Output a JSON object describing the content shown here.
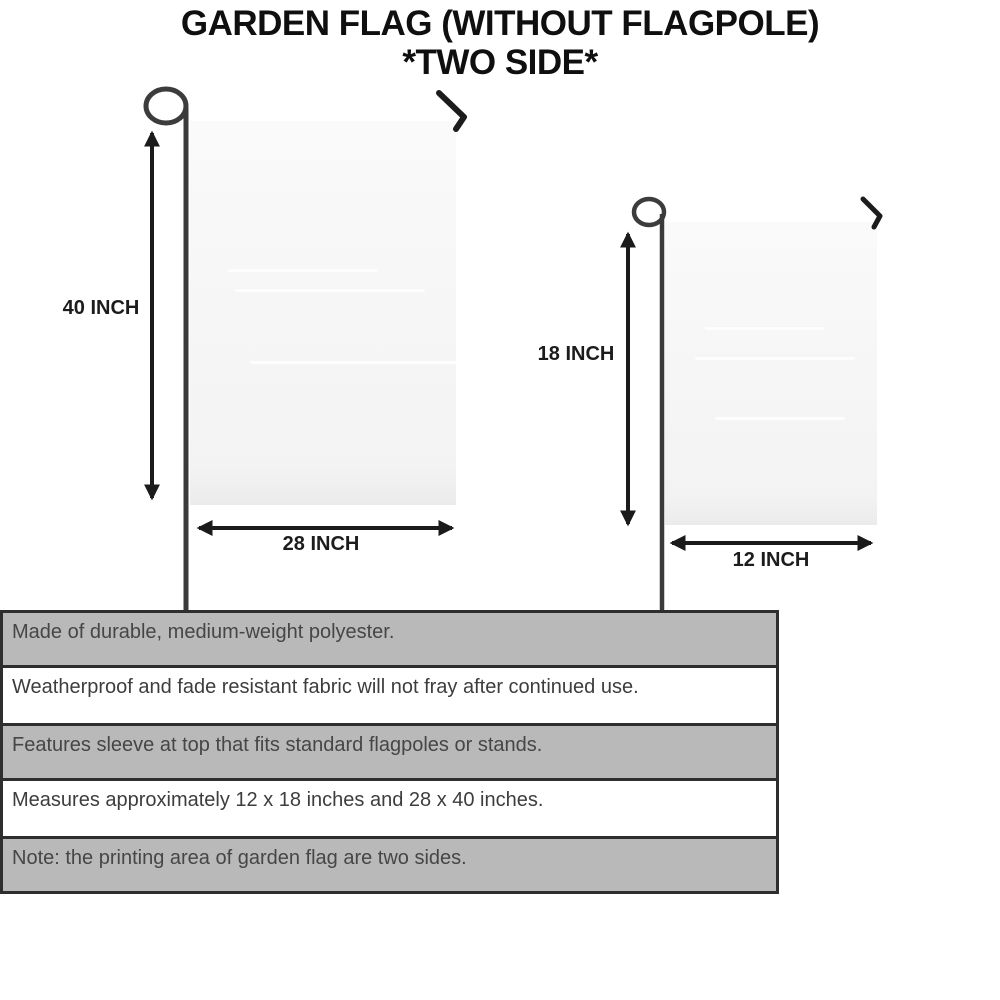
{
  "title": {
    "line1": "GARDEN FLAG (WITHOUT FLAGPOLE)",
    "line2": "*TWO SIDE*"
  },
  "diagram": {
    "large_flag": {
      "height_label": "40 INCH",
      "width_label": "28 INCH"
    },
    "small_flag": {
      "height_label": "18 INCH",
      "width_label": "12 INCH"
    }
  },
  "features": {
    "rows": [
      {
        "text": "Made of durable, medium-weight polyester."
      },
      {
        "text": "Weatherproof and fade resistant fabric will not fray after continued use."
      },
      {
        "text": "Features sleeve at top that fits standard flagpoles or stands."
      },
      {
        "text": "Measures approximately 12 x 18 inches and 28 x 40 inches."
      },
      {
        "text": "Note: the printing area of garden flag are two sides."
      }
    ]
  },
  "colors": {
    "stripe_gray": "#b9b9b9",
    "stripe_white": "#ffffff",
    "stripe_border": "#2e2e2e",
    "flag_fill": "#f6f6f6",
    "pole": "#3a3a3a",
    "arrow_ink": "#1b1b1b",
    "title_ink": "#0f0f0f",
    "feature_text": "#464646"
  }
}
